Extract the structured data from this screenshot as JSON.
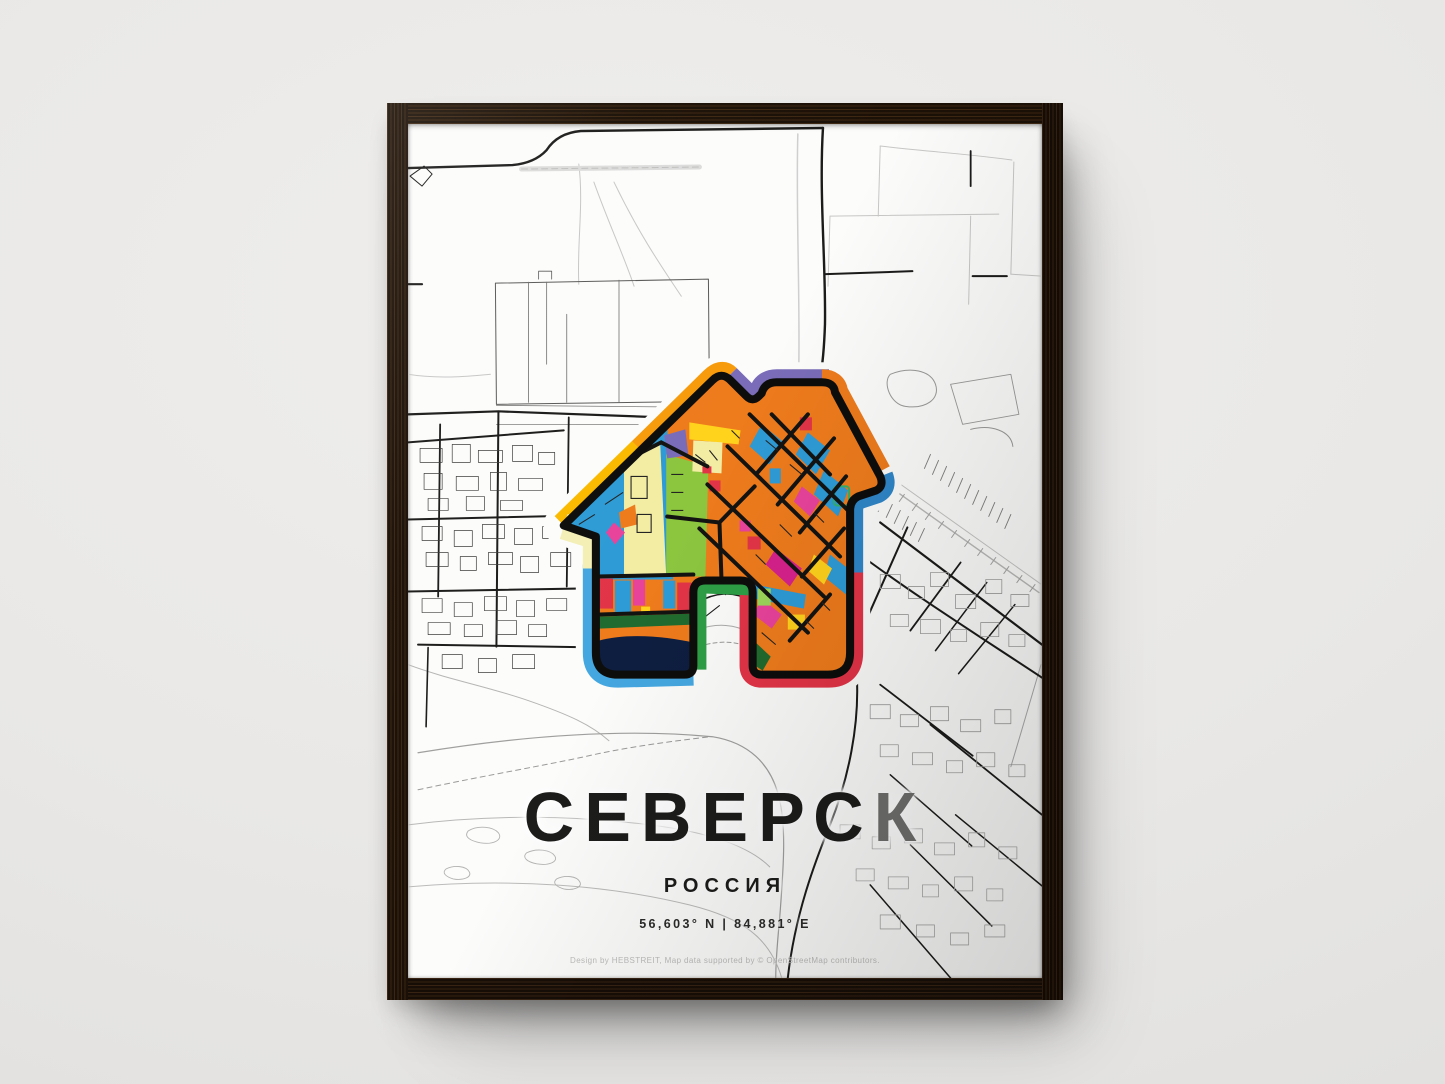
{
  "wall": {
    "color": "#e9e8e6"
  },
  "frame": {
    "wood_color": "#241609"
  },
  "poster": {
    "title": {
      "main": "СЕВЕРС",
      "accent": "К",
      "full": "СЕВЕРСК"
    },
    "subtitle": "РОССИЯ",
    "coordinates": "56,603° N | 84,881° E",
    "credit": "Design by HEBSTREIT, Map data supported by © OpenStreetMap contributors.",
    "colors": {
      "title": "#1c1c1a",
      "title_accent": "#6f6f6d",
      "credit_text": "#bdbdbb",
      "road_dark": "#1a1a1a",
      "road_light": "#c4c4c4",
      "icon_orange": "#EE7B1C",
      "icon_blue": "#2E9BD6",
      "icon_yellow": "#FFD21C",
      "icon_cream": "#F3EDA4",
      "icon_green": "#8CC63F",
      "icon_dark_green": "#206B2F",
      "icon_pink": "#E8439B",
      "icon_red": "#E23447",
      "icon_navy": "#0E1E40",
      "icon_purple": "#7A6CB8",
      "icon_lightblue": "#45A7E0",
      "icon_border_green": "#2E9E46",
      "icon_border_yellow": "#FBBA00"
    }
  }
}
